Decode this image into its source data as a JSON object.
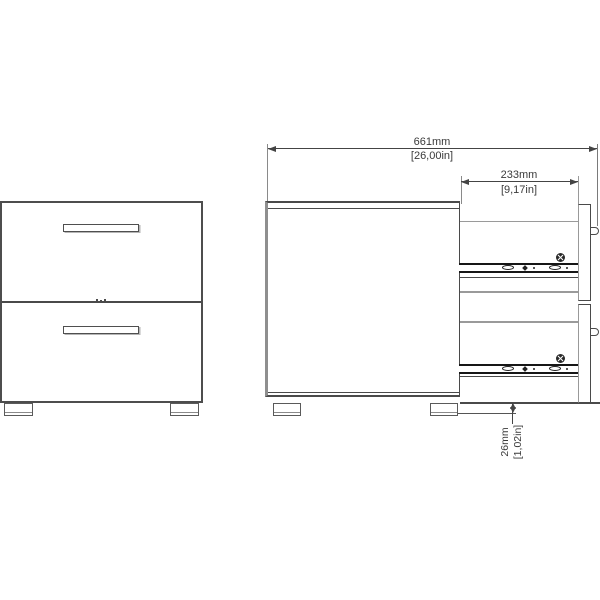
{
  "drawing": {
    "title": "two-drawer cabinet dimension drawing",
    "dimensions": {
      "total_depth": {
        "metric": "661mm",
        "imperial": "[26,00in]"
      },
      "drawer_extension": {
        "metric": "233mm",
        "imperial": "[9,17in]"
      },
      "floor_clearance": {
        "metric": "26mm",
        "imperial": "[1,02in]"
      }
    },
    "icons": {
      "screw_head_icon": "circle-with-cross",
      "drawer_slide_icon": "rail-with-oval-slots"
    },
    "colors": {
      "line": "#4a4a4a",
      "secondary_line": "#9a9a9a",
      "rail": "#161616",
      "background": "#ffffff"
    }
  }
}
